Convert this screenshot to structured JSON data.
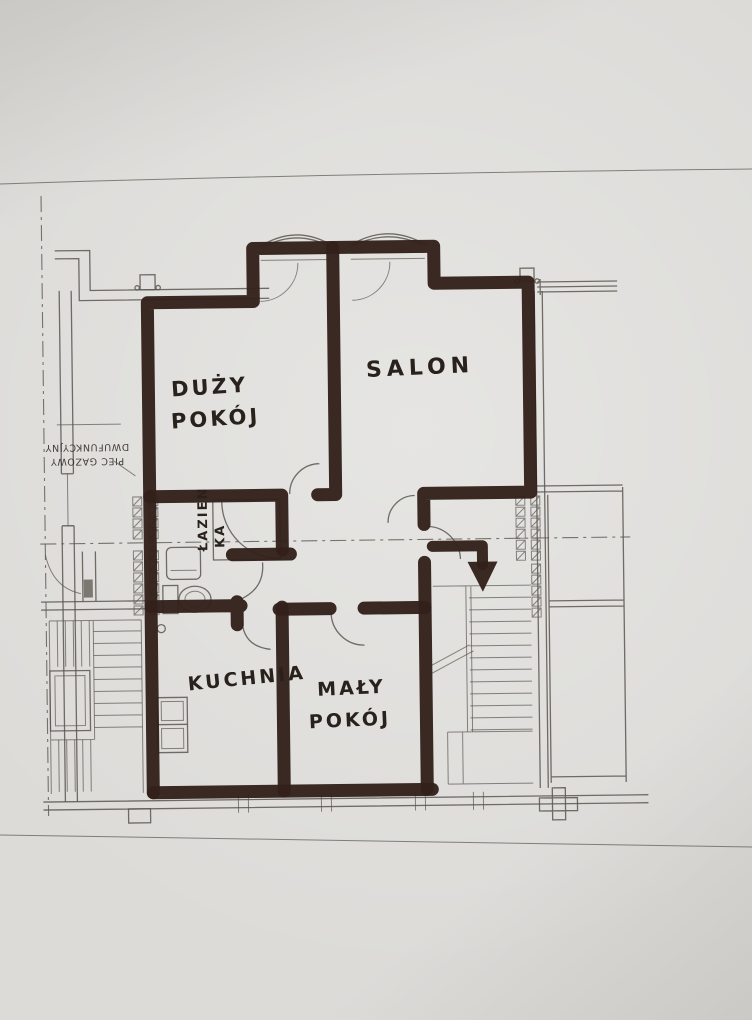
{
  "floor_plan": {
    "rooms": [
      {
        "id": "duzy-pokoj",
        "label_line1": "DUŻY",
        "label_line2": "POKÓJ"
      },
      {
        "id": "salon",
        "label_line1": "SALON",
        "label_line2": ""
      },
      {
        "id": "lazienka",
        "label_line1": "ŁAZIEN",
        "label_line2": "KA"
      },
      {
        "id": "kuchnia",
        "label_line1": "KUCHNIA",
        "label_line2": ""
      },
      {
        "id": "maly-pokoj",
        "label_line1": "MAŁY",
        "label_line2": "POKÓJ"
      }
    ],
    "printed_note": {
      "line1": "PIEC GAZOWY",
      "line2": "DWUFUNKCYJNY"
    }
  },
  "colors": {
    "paper": "#dcdbd8",
    "pencil": "#5a564f",
    "marker": "#33201a",
    "ink": "#29211c"
  }
}
